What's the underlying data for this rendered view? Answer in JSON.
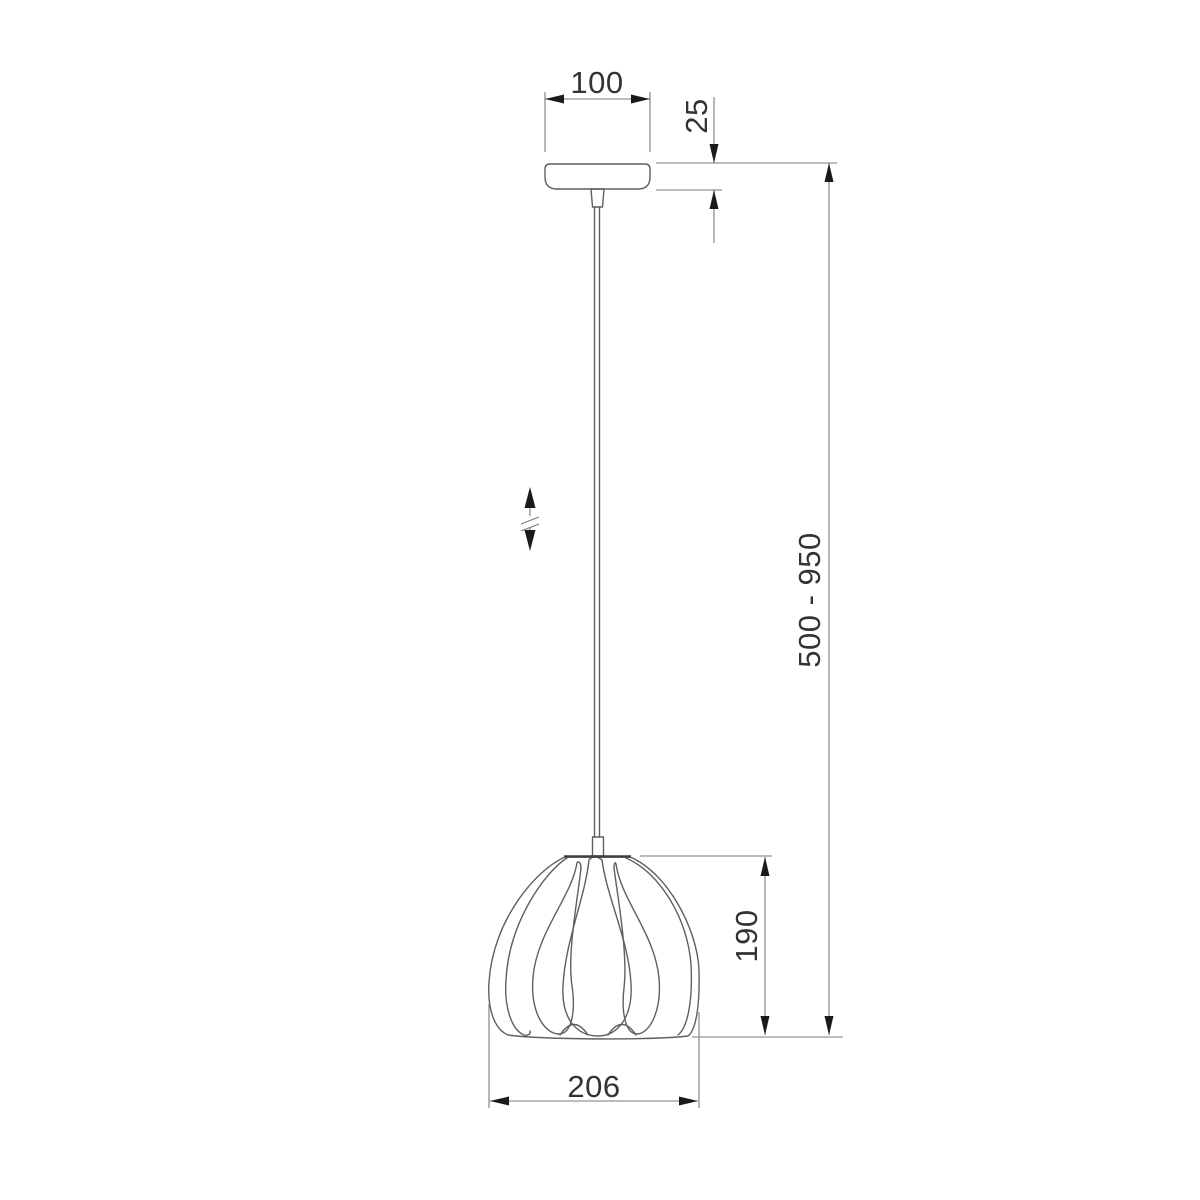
{
  "page": {
    "background": "#ffffff",
    "drawing_type": "pendant-lamp dimension drawing"
  },
  "colors": {
    "object_line": "#5f5f5f",
    "rim_line": "#3f3f3f",
    "dimension_line": "#7a7a7a",
    "arrow": "#1a1a1a",
    "label_text": "#333333"
  },
  "labels": {
    "canopy_width": "100",
    "canopy_height": "25",
    "suspension_range": "500 - 950",
    "shade_height": "190",
    "shade_width": "206"
  },
  "icons": {
    "height_adjustment": "up-down-arrows-with-break-mark"
  }
}
